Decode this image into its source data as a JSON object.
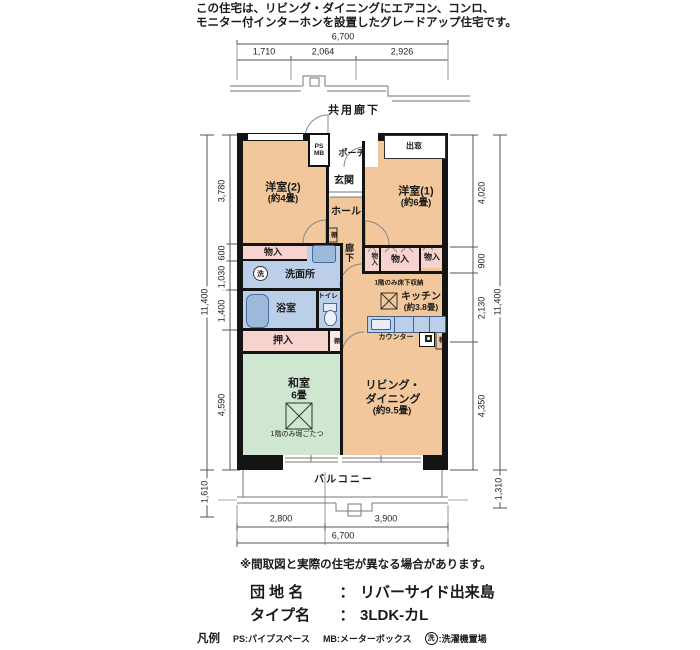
{
  "header": {
    "line1": "この住宅は、リビング・ダイニングにエアコン、コンロ、",
    "line2": "モニター付インターホンを設置したグレードアップ住宅です。"
  },
  "site": {
    "corridor_label": "共用廊下",
    "balcony_label": "バルコニー"
  },
  "dims": {
    "top_total": "6,700",
    "top_segs": [
      "1,710",
      "2,064",
      "2,926"
    ],
    "bottom_segs": [
      "2,800",
      "3,900"
    ],
    "bottom_total": "6,700",
    "left_total": "11,400",
    "left_segs": [
      "3,780",
      "600",
      "1,030",
      "1,400",
      "4,590"
    ],
    "left_balcony": "1,610",
    "right_total": "11,400",
    "right_segs": [
      "4,020",
      "900",
      "2,130",
      "4,350"
    ],
    "right_balcony": "1,310"
  },
  "rooms": {
    "western2_name": "洋室(2)",
    "western2_size": "(約4畳)",
    "western1_name": "洋室(1)",
    "western1_size": "(約6畳)",
    "ps": "PS",
    "mb": "MB",
    "porch": "ポーチ",
    "bay_window": "出窓",
    "entrance": "玄関",
    "hall": "ホール",
    "corridor": "廊下",
    "closet_left": "物入",
    "washroom": "洗面所",
    "washer_mark": "洗",
    "bath": "浴室",
    "toilet": "トイレ",
    "oshiire": "押入",
    "shelf": "棚",
    "closet_a": "物入",
    "closet_b": "物入",
    "closet_c": "物入",
    "underfloor_note": "1階のみ床下収納",
    "kitchen_name": "キッチン",
    "kitchen_size": "(約3.8畳)",
    "counter": "カウンター",
    "living_line1": "リビング・",
    "living_line2": "ダイニング",
    "living_size": "(約9.5畳)",
    "washitsu_name": "和室",
    "washitsu_size": "6畳",
    "washitsu_note": "1階のみ堀ごたつ"
  },
  "footer": {
    "disclaimer": "※間取図と実際の住宅が異なる場合があります。",
    "estate_label": "団 地 名",
    "colon": "：",
    "estate_value": "リバーサイド出来島",
    "type_label": "タイプ名",
    "type_value": "3LDK-カL",
    "legend_title": "凡例",
    "legend_ps": "PS:パイプスペース",
    "legend_mb": "MB:メーターボックス",
    "legend_wash_suffix": ":洗濯機置場"
  },
  "colors": {
    "room": "#f2c79b",
    "closet": "#f6d3cf",
    "wet": "#bccfe8",
    "fixture": "#9db9dc",
    "tatami": "#cfe6d0",
    "wall": "#141414",
    "dimline": "#555555"
  }
}
